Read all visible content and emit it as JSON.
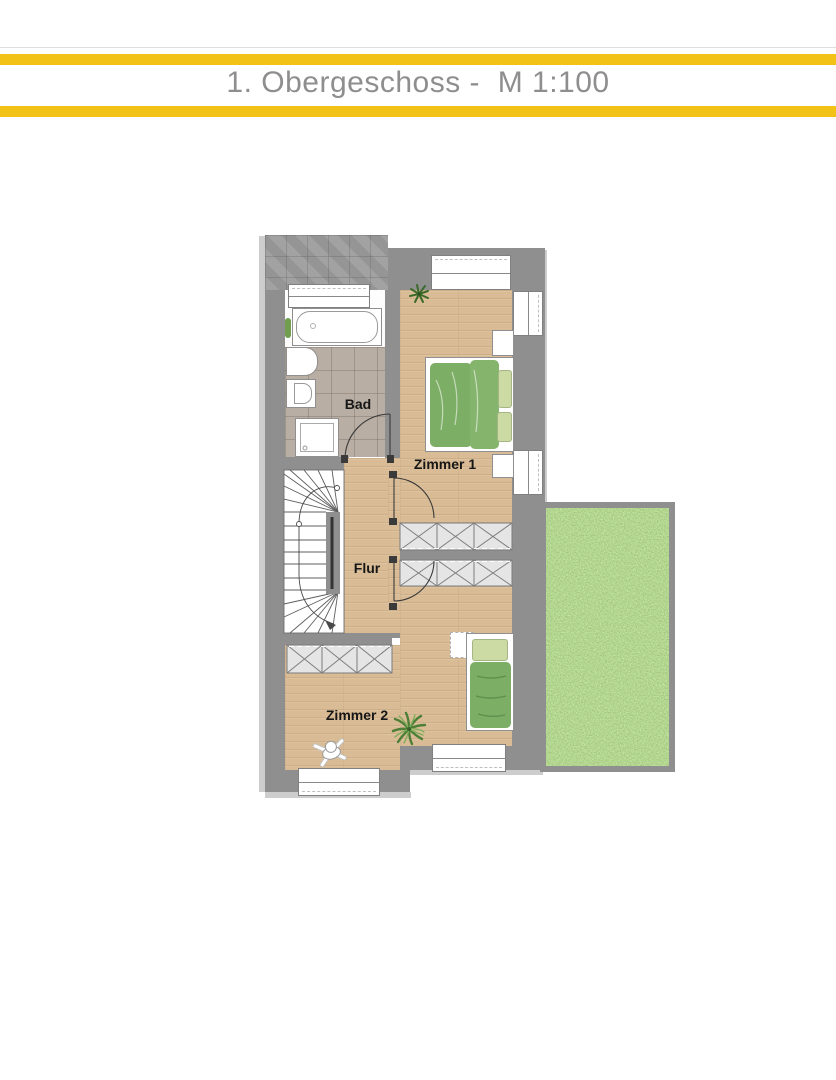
{
  "header": {
    "title": "1. Obergeschoss -  M 1:100",
    "accent_bar_color": "#F3C216",
    "title_color": "#8E8E8E"
  },
  "plan": {
    "rooms": {
      "bad": {
        "label": "Bad"
      },
      "zimmer1": {
        "label": "Zimmer 1"
      },
      "flur": {
        "label": "Flur"
      },
      "zimmer2": {
        "label": "Zimmer 2"
      }
    },
    "colors": {
      "wall_gray": "#8F8F8F",
      "wood_floor": "#D9BC95",
      "bath_tile": "#B8AEA3",
      "lawn_green": "#7CA64F",
      "bed_green": "#7DAE65",
      "pillow_green": "#CCDAA3"
    },
    "objects": [
      "bathtub",
      "washbasin",
      "toilet",
      "shower",
      "staircase",
      "wardrobes",
      "double-bed",
      "single-bed",
      "windows",
      "doors",
      "lawn",
      "palm-plant",
      "potted-plant",
      "toy-figure"
    ]
  }
}
